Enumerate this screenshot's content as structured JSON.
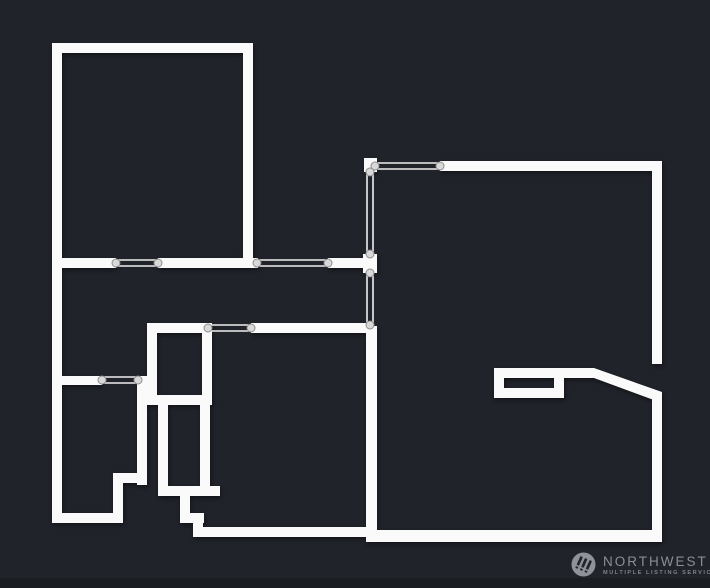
{
  "page": {
    "width": 710,
    "height": 588,
    "background": "#20232a",
    "footer_strip_color": "#1a1d22"
  },
  "floorplan": {
    "wall_color": "#fafafa",
    "shadow": "drop-shadow(1px 2px 2px rgba(0,0,0,0.45))",
    "opening_style": {
      "line_color": "#f0f0f0",
      "line_width": 1.6,
      "line_offset": 3,
      "circle_radius": 4,
      "circle_fill": "#d8d8d8",
      "circle_stroke": "#8d8d8d"
    },
    "walls": [
      {
        "name": "wall-top-left-room-top",
        "x": 52,
        "y": 43,
        "w": 201,
        "h": 10
      },
      {
        "name": "wall-left-outer",
        "x": 52,
        "y": 43,
        "w": 10,
        "h": 480
      },
      {
        "name": "wall-top-left-room-right",
        "x": 243,
        "y": 43,
        "w": 10,
        "h": 225
      },
      {
        "name": "wall-hall-a",
        "x": 52,
        "y": 258,
        "w": 64,
        "h": 10
      },
      {
        "name": "wall-hall-b",
        "x": 158,
        "y": 258,
        "w": 100,
        "h": 10
      },
      {
        "name": "wall-hall-c",
        "x": 328,
        "y": 258,
        "w": 38,
        "h": 10
      },
      {
        "name": "wall-junction-stub",
        "x": 363,
        "y": 254,
        "w": 14,
        "h": 19
      },
      {
        "name": "wall-right-room-corner-stub",
        "x": 364,
        "y": 158,
        "w": 13,
        "h": 14
      },
      {
        "name": "wall-right-room-top",
        "x": 440,
        "y": 161,
        "w": 222,
        "h": 10
      },
      {
        "name": "wall-right-outer-upper",
        "x": 652,
        "y": 161,
        "w": 10,
        "h": 203
      },
      {
        "name": "wall-right-outer-lower",
        "x": 652,
        "y": 394,
        "w": 10,
        "h": 148
      },
      {
        "name": "wall-right-room-bottom",
        "x": 366,
        "y": 530,
        "w": 296,
        "h": 12
      },
      {
        "name": "wall-right-room-left",
        "x": 366,
        "y": 326,
        "w": 11,
        "h": 210
      },
      {
        "name": "wall-fireplace-stub",
        "x": 494,
        "y": 368,
        "w": 100,
        "h": 10
      },
      {
        "name": "wall-fireplace-left",
        "x": 494,
        "y": 378,
        "w": 10,
        "h": 20
      },
      {
        "name": "wall-fireplace-bottom",
        "x": 494,
        "y": 388,
        "w": 70,
        "h": 10
      },
      {
        "name": "wall-fireplace-right",
        "x": 554,
        "y": 378,
        "w": 10,
        "h": 20
      },
      {
        "name": "wall-mid-a",
        "x": 147,
        "y": 323,
        "w": 63,
        "h": 10
      },
      {
        "name": "wall-mid-b",
        "x": 251,
        "y": 323,
        "w": 117,
        "h": 10
      },
      {
        "name": "wall-closet-left",
        "x": 147,
        "y": 323,
        "w": 10,
        "h": 82
      },
      {
        "name": "wall-closet-bottom",
        "x": 147,
        "y": 395,
        "w": 65,
        "h": 10
      },
      {
        "name": "wall-closet-right",
        "x": 202,
        "y": 323,
        "w": 10,
        "h": 82
      },
      {
        "name": "wall-stair-right",
        "x": 200,
        "y": 405,
        "w": 10,
        "h": 83
      },
      {
        "name": "wall-stair-left",
        "x": 158,
        "y": 405,
        "w": 10,
        "h": 83
      },
      {
        "name": "wall-stair-tread-1",
        "x": 158,
        "y": 486,
        "w": 62,
        "h": 10
      },
      {
        "name": "wall-stair-riser-1",
        "x": 180,
        "y": 496,
        "w": 10,
        "h": 20
      },
      {
        "name": "wall-stair-tread-2",
        "x": 180,
        "y": 513,
        "w": 24,
        "h": 10
      },
      {
        "name": "wall-stair-riser-2",
        "x": 193,
        "y": 523,
        "w": 10,
        "h": 9
      },
      {
        "name": "wall-bottom-run",
        "x": 193,
        "y": 527,
        "w": 180,
        "h": 10
      },
      {
        "name": "wall-bl-door-a",
        "x": 52,
        "y": 376,
        "w": 50,
        "h": 9
      },
      {
        "name": "wall-bl-door-b",
        "x": 138,
        "y": 376,
        "w": 9,
        "h": 9
      },
      {
        "name": "wall-bl-room-right",
        "x": 137,
        "y": 376,
        "w": 10,
        "h": 109
      },
      {
        "name": "wall-bl-jog-h",
        "x": 113,
        "y": 473,
        "w": 34,
        "h": 10
      },
      {
        "name": "wall-bl-jog-v",
        "x": 113,
        "y": 473,
        "w": 10,
        "h": 50
      },
      {
        "name": "wall-bl-room-bottom",
        "x": 52,
        "y": 513,
        "w": 71,
        "h": 10
      }
    ],
    "polygons": [
      {
        "name": "wall-angled-corner",
        "points": "594,368 662,392 662,403 594,378"
      }
    ],
    "openings": [
      {
        "name": "opening-hall-1",
        "dir": "h",
        "a": 116,
        "b": 158,
        "c": 263
      },
      {
        "name": "opening-hall-2",
        "dir": "h",
        "a": 257,
        "b": 328,
        "c": 263
      },
      {
        "name": "opening-right-room-top",
        "dir": "h",
        "a": 375,
        "b": 440,
        "c": 166
      },
      {
        "name": "opening-right-room-upper",
        "dir": "v",
        "a": 172,
        "b": 254,
        "c": 370
      },
      {
        "name": "opening-right-room-lower",
        "dir": "v",
        "a": 273,
        "b": 325,
        "c": 370
      },
      {
        "name": "opening-closet-door",
        "dir": "h",
        "a": 208,
        "b": 251,
        "c": 328
      },
      {
        "name": "opening-bottom-left-room",
        "dir": "h",
        "a": 102,
        "b": 138,
        "c": 380
      }
    ]
  },
  "watermark": {
    "brand": "NORTHWEST",
    "tagline": "MULTIPLE LISTING SERVICE®",
    "text_color": "#8a8e95",
    "tagline_color": "#7f838a",
    "circle_color": "#8f9298",
    "glyph_color": "#22252c"
  }
}
